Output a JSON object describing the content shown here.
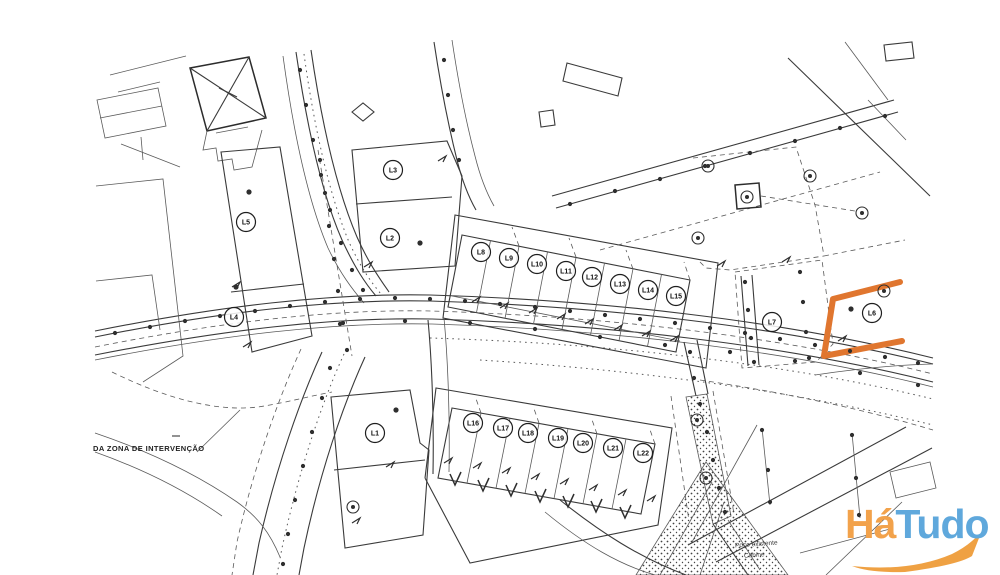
{
  "annotations": {
    "zone": "DA ZONA DE INTERVENÇÃO",
    "well": "Poço existente",
    "cabin": "Cabine"
  },
  "watermark": {
    "text_ha": "Há",
    "text_tudo": "Tudo",
    "colors": {
      "ha": "#F2A24B",
      "tudo": "#5FA8DC",
      "swoosh": "#EFA143"
    }
  },
  "highlight": {
    "lot": "L6",
    "color": "#E0762F"
  },
  "map_data": {
    "type": "site-plan",
    "lot_markers": [
      {
        "label": "L1",
        "x": 375,
        "y": 433
      },
      {
        "label": "L2",
        "x": 390,
        "y": 238
      },
      {
        "label": "L3",
        "x": 393,
        "y": 170
      },
      {
        "label": "L4",
        "x": 234,
        "y": 317
      },
      {
        "label": "L5",
        "x": 246,
        "y": 222
      },
      {
        "label": "L6",
        "x": 872,
        "y": 313
      },
      {
        "label": "L7",
        "x": 772,
        "y": 322
      },
      {
        "label": "L8",
        "x": 481,
        "y": 252
      },
      {
        "label": "L9",
        "x": 509,
        "y": 258
      },
      {
        "label": "L10",
        "x": 537,
        "y": 264
      },
      {
        "label": "L11",
        "x": 566,
        "y": 271
      },
      {
        "label": "L12",
        "x": 592,
        "y": 277
      },
      {
        "label": "L13",
        "x": 620,
        "y": 284
      },
      {
        "label": "L14",
        "x": 648,
        "y": 290
      },
      {
        "label": "L15",
        "x": 676,
        "y": 296
      },
      {
        "label": "L16",
        "x": 473,
        "y": 423
      },
      {
        "label": "L17",
        "x": 503,
        "y": 428
      },
      {
        "label": "L18",
        "x": 528,
        "y": 433
      },
      {
        "label": "L19",
        "x": 558,
        "y": 438
      },
      {
        "label": "L20",
        "x": 583,
        "y": 443
      },
      {
        "label": "L21",
        "x": 613,
        "y": 448
      },
      {
        "label": "L22",
        "x": 643,
        "y": 453
      }
    ],
    "check_marks": [
      [
        455,
        480
      ],
      [
        483,
        486
      ],
      [
        511,
        491
      ],
      [
        540,
        497
      ],
      [
        568,
        502
      ],
      [
        596,
        507
      ],
      [
        625,
        513
      ]
    ],
    "double_circles": [
      [
        708,
        166
      ],
      [
        698,
        238
      ],
      [
        862,
        213
      ],
      [
        810,
        176
      ],
      [
        697,
        420
      ],
      [
        706,
        478
      ],
      [
        353,
        507
      ],
      [
        747,
        197
      ],
      [
        884,
        291
      ]
    ],
    "interior_dots": [
      [
        249,
        192
      ],
      [
        236,
        287
      ],
      [
        420,
        243
      ],
      [
        851,
        309
      ],
      [
        396,
        410
      ]
    ],
    "ticks": [
      [
        476,
        299
      ],
      [
        504,
        305
      ],
      [
        533,
        310
      ],
      [
        561,
        316
      ],
      [
        589,
        321
      ],
      [
        618,
        327
      ],
      [
        646,
        333
      ],
      [
        674,
        338
      ],
      [
        448,
        460
      ],
      [
        477,
        465
      ],
      [
        506,
        470
      ],
      [
        535,
        476
      ],
      [
        564,
        481
      ],
      [
        593,
        487
      ],
      [
        622,
        492
      ],
      [
        651,
        498
      ],
      [
        247,
        344
      ],
      [
        236,
        284
      ],
      [
        368,
        264
      ],
      [
        442,
        158
      ],
      [
        390,
        464
      ],
      [
        356,
        520
      ],
      [
        842,
        338
      ],
      [
        721,
        263
      ],
      [
        786,
        259
      ]
    ],
    "survey_dots": [
      [
        115,
        333
      ],
      [
        150,
        327
      ],
      [
        185,
        321
      ],
      [
        220,
        316
      ],
      [
        255,
        311
      ],
      [
        290,
        306
      ],
      [
        325,
        302
      ],
      [
        360,
        299
      ],
      [
        395,
        298
      ],
      [
        430,
        299
      ],
      [
        465,
        301
      ],
      [
        500,
        304
      ],
      [
        535,
        307
      ],
      [
        570,
        311
      ],
      [
        605,
        315
      ],
      [
        640,
        319
      ],
      [
        675,
        323
      ],
      [
        710,
        328
      ],
      [
        745,
        333
      ],
      [
        780,
        339
      ],
      [
        815,
        345
      ],
      [
        850,
        351
      ],
      [
        885,
        357
      ],
      [
        918,
        363
      ],
      [
        340,
        324
      ],
      [
        405,
        321
      ],
      [
        470,
        323
      ],
      [
        535,
        329
      ],
      [
        600,
        337
      ],
      [
        665,
        345
      ],
      [
        730,
        352
      ],
      [
        795,
        361
      ],
      [
        860,
        373
      ],
      [
        918,
        385
      ],
      [
        300,
        70
      ],
      [
        306,
        105
      ],
      [
        313,
        140
      ],
      [
        321,
        175
      ],
      [
        330,
        210
      ],
      [
        341,
        243
      ],
      [
        352,
        270
      ],
      [
        363,
        290
      ],
      [
        320,
        160
      ],
      [
        325,
        193
      ],
      [
        329,
        226
      ],
      [
        334,
        259
      ],
      [
        338,
        291
      ],
      [
        343,
        323
      ],
      [
        347,
        350
      ],
      [
        570,
        204
      ],
      [
        615,
        191
      ],
      [
        660,
        179
      ],
      [
        705,
        166
      ],
      [
        750,
        153
      ],
      [
        795,
        141
      ],
      [
        840,
        128
      ],
      [
        885,
        116
      ],
      [
        330,
        368
      ],
      [
        322,
        398
      ],
      [
        312,
        432
      ],
      [
        303,
        466
      ],
      [
        295,
        500
      ],
      [
        288,
        534
      ],
      [
        283,
        564
      ],
      [
        690,
        352
      ],
      [
        694,
        378
      ],
      [
        700,
        404
      ],
      [
        707,
        432
      ],
      [
        713,
        460
      ],
      [
        719,
        488
      ],
      [
        725,
        512
      ],
      [
        745,
        282
      ],
      [
        748,
        310
      ],
      [
        751,
        338
      ],
      [
        754,
        362
      ],
      [
        800,
        272
      ],
      [
        803,
        302
      ],
      [
        806,
        332
      ],
      [
        809,
        358
      ],
      [
        444,
        60
      ],
      [
        448,
        95
      ],
      [
        453,
        130
      ],
      [
        459,
        160
      ],
      [
        762,
        430
      ],
      [
        768,
        470
      ],
      [
        770,
        502
      ],
      [
        852,
        435
      ],
      [
        856,
        478
      ],
      [
        859,
        515
      ]
    ]
  }
}
